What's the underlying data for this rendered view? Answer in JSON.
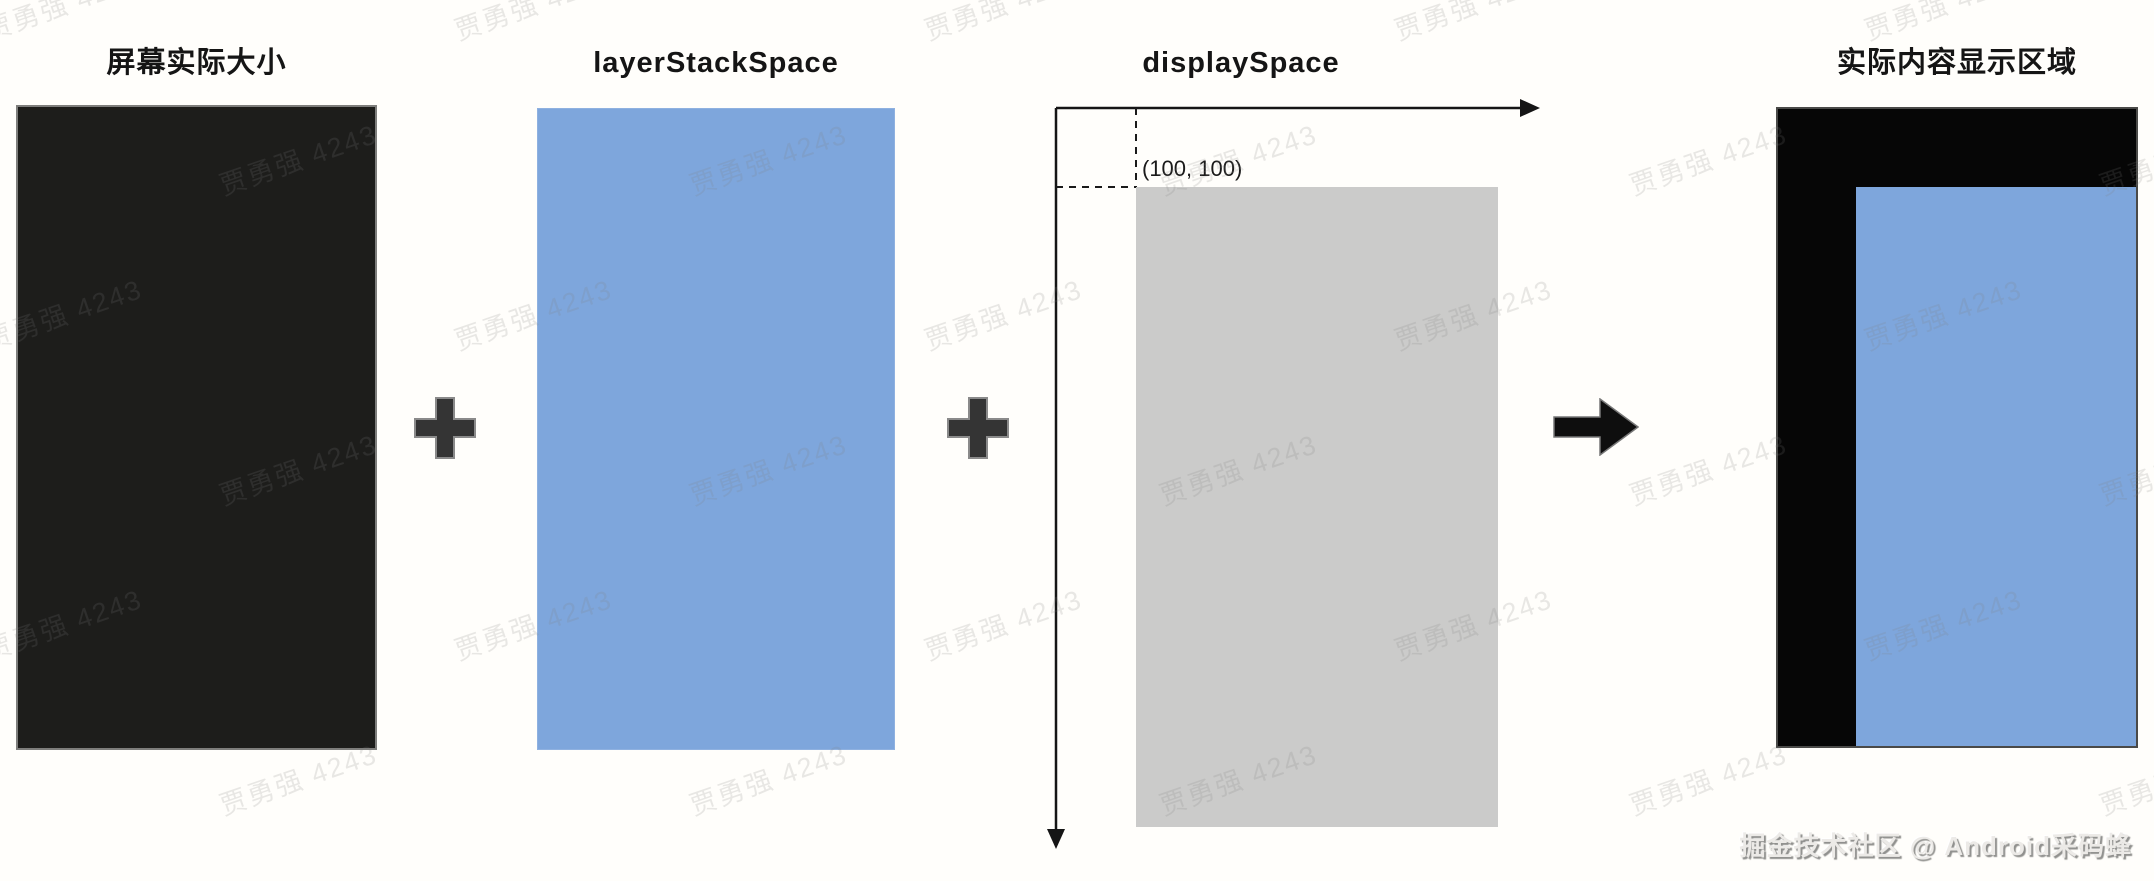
{
  "panels": {
    "screen": {
      "title": "屏幕实际大小"
    },
    "layer_stack": {
      "title": "layerStackSpace"
    },
    "display": {
      "title": "displaySpace",
      "origin_label": "(100, 100)"
    },
    "result": {
      "title": "实际内容显示区域"
    }
  },
  "watermark": {
    "text": "贾勇强 4243"
  },
  "credit": {
    "text": "掘金技术社区 @ Android采码蜂"
  },
  "colors": {
    "bg": "#fffefb",
    "screen_black": "#1d1d1b",
    "layer_blue": "#7ea6dc",
    "display_gray": "#cbcbca",
    "result_black": "#060606",
    "operator_dark": "#343434",
    "arrow_black": "#0e0e0e",
    "axis_black": "#151515"
  }
}
